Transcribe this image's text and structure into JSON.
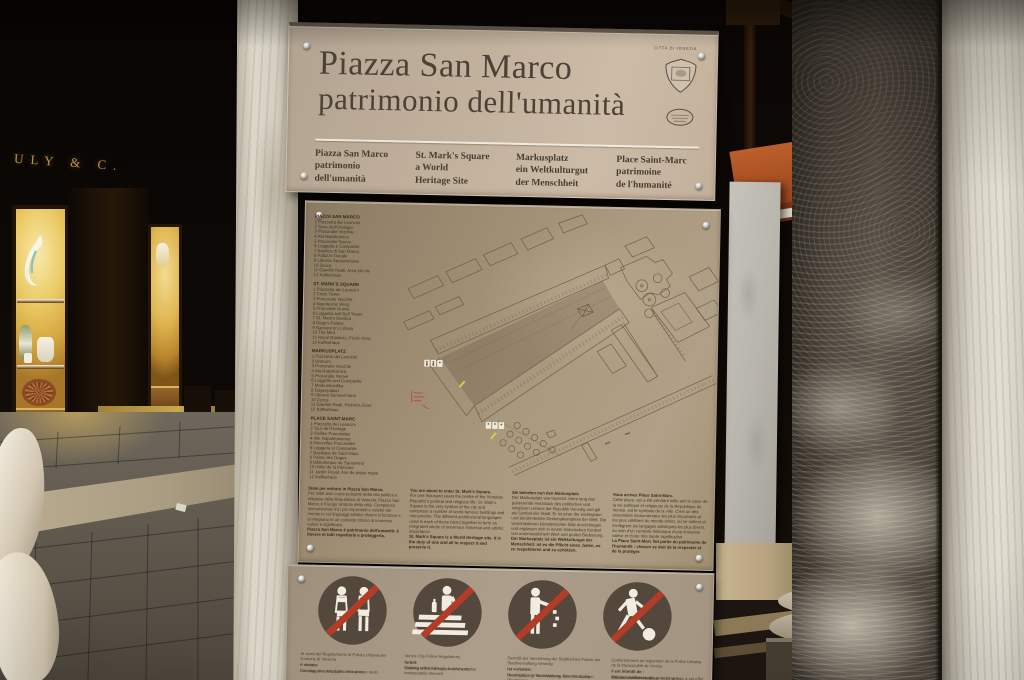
{
  "colors": {
    "panel_beige": "#c0af9b",
    "panel_tan": "#a4937a",
    "prohibition_red": "#b23c28",
    "pictogram_circle_brown": "#54473b",
    "title_brown": "#4b4136",
    "shop_glow_gold": "#eccb67"
  },
  "scene": {
    "shop_sign_text": "ULY & C."
  },
  "sign": {
    "header": {
      "title_line1": "Piazza San Marco",
      "title_line2": "patrimonio dell'umanità",
      "crest_caption": "CITTÀ DI VENEZIA",
      "translations": [
        {
          "lines": [
            "Piazza San Marco",
            "patrimonio",
            "dell'umanità"
          ]
        },
        {
          "lines": [
            "St. Mark's Square",
            "a World",
            "Heritage Site"
          ]
        },
        {
          "lines": [
            "Markusplatz",
            "ein Weltkulturgut",
            "der Menschheit"
          ]
        },
        {
          "lines": [
            "Place Saint-Marc",
            "patrimoine",
            "de l'humanité"
          ]
        }
      ]
    },
    "map_panel": {
      "legend": [
        {
          "title": "PIAZZA SAN MARCO",
          "items": [
            "1 Piazzetta dei Leoncini",
            "2 Torre dell'Orologio",
            "3 Procuratie Vecchie",
            "4 Ala Napoleonica",
            "5 Procuratie Nuove",
            "6 Loggetta e Campanile",
            "7 Basilica di San Marco",
            "8 Palazzo Ducale",
            "9 Libreria Sansoviniana",
            "10 Zecca",
            "11 Giardini Reali, Area pic-nic",
            "12 Kaffeehaus"
          ]
        },
        {
          "title": "ST. MARK'S SQUARE",
          "items": [
            "1 Piazzetta dei Leoncini",
            "2 Clock Tower",
            "3 Procuratie Vecchie",
            "4 Napoleonic Wing",
            "5 Procuratie Nuove",
            "6 Loggetta and Bell Tower",
            "7 St. Mark's Basilica",
            "8 Doge's Palace",
            "9 Sansovino's Library",
            "10 The Mint",
            "11 Royal Gardens, Picnic Area",
            "12 Kaffeehaus"
          ]
        },
        {
          "title": "MARKUSPLATZ",
          "items": [
            "1 Piazzetta dei Leoncini",
            "2 Uhrturm",
            "3 Procuratie Vecchie",
            "4 Ala Napoleonica",
            "5 Procuratie Nuove",
            "6 Loggetta und Campanile",
            "7 Markusbasilika",
            "8 Dogenpalast",
            "9 Libreria Sansoviniana",
            "10 Zecca",
            "11 Giardini Reali, Picknick-Zone",
            "12 Kaffeehaus"
          ]
        },
        {
          "title": "PLACE SAINT-MARC",
          "items": [
            "1 Piazzetta dei Leoncini",
            "2 Tour de l'Horloge",
            "3 Vieilles Procuraties",
            "4 Aile Napoléonienne",
            "5 Nouvelles Procuraties",
            "6 Loggetta et Campanile",
            "7 Basilique de Saint-Marc",
            "8 Palais des Doges",
            "9 Bibliothèque de Sansovino",
            "10 Hôtel de la Monnaie",
            "11 Jardin Royal, Aire de pique-nique",
            "12 Kaffeehaus"
          ]
        }
      ],
      "intro": [
        {
          "lead": "State per entrare in Piazza San Marco.",
          "body": "Per mille anni cuore pulsante della vita politica e religiosa della Repubblica di Venezia, Piazza San Marco è il luogo simbolo della città. Complesso monumentale tra i più importanti e celebri del mondo in cui linguaggi artistici diversi si fondono e si integrano in un contesto storico di immenso valore e significato.",
          "bold": "Piazza San Marco è patrimonio dell'umanità: è dovere di tutti rispettarla e proteggerla."
        },
        {
          "lead": "You are about to enter St. Mark's Square.",
          "body": "For one thousand years the centre of the Venetian Republic's political and religious life, St. Mark's Square is the very symbol of the city and comprises a number of world-famous buildings and monuments. The different architectural languages used in each of these blend together to form an integrated whole of enormous historical and artistic importance.",
          "bold": "St. Mark's Square is a World Heritage site. It is the duty of one and all to respect it and preserve it."
        },
        {
          "lead": "Sie betreten nun den Markusplatz.",
          "body": "Der Markusplatz war tausend Jahre lang das pulsierende Herzstück des politischen und religiösen Lebens der Republik Venedig und gilt als Symbol der Stadt. Er ist einer der wichtigsten und berühmtesten Denkmalkomplexe der Welt. Die verschiedenen künstlerischen Stile durchdringen und ergänzen sich in einem historischen Kontext von unermesslichem Wert und großer Bedeutung.",
          "bold": "Der Markusplatz ist ein Weltkulturgut der Menschheit: ist es die Pflicht eines Jeden, es zu respektieren und zu schützen."
        },
        {
          "lead": "Vous arrivez Place Saint-Marc.",
          "body": "Cette place, qui a été pendant mille ans le cœur de la vie politique et religieuse de la République de Venise, est le symbole de la ville. C'est un des ensembles monumentaux les plus importants et les plus célèbres du monde entier, où se mêlent et s'intègrent les langages artistiques les plus divers, au sein d'un contexte historique d'une immense valeur et d'une très haute signification.",
          "bold": "La Place Saint-Marc fait partie du patrimoine de l'humanité : chacun se doit de la respecter et de la protéger."
        }
      ]
    },
    "rules_panel": {
      "icons": [
        {
          "name": "no-beachwear"
        },
        {
          "name": "no-picnicking"
        },
        {
          "name": "no-littering"
        },
        {
          "name": "no-ball-games"
        }
      ],
      "columns": [
        {
          "authority": "Ai sensi del Regolamento di Polizia Urbana del Comune di Venezia",
          "forbid": "è vietato:",
          "items": [
            "Circolare in tenuta balneare o a torso nudo",
            "Danneggiare, deturpare, imbrattare"
          ]
        },
        {
          "authority": "Venice City Police Regulations",
          "forbid": "forbid:",
          "items": [
            "Walking around the city bare-chested or inadequately dressed",
            "Causing wilful damage or defacement"
          ]
        },
        {
          "authority": "Gemäß der Verordnung der Städtischen Polizei der Stadtverwaltung Venedig",
          "forbid": "ist verboten:",
          "items": [
            "Herumgehen in Badekleidung oder mit nacktem Oberkörper",
            "Beschädigung, Verunstaltung, Beschmutzung"
          ]
        },
        {
          "authority": "Conformément au règlement de la Police Urbaine de la Municipalité de Venise",
          "forbid": "il est interdit de :",
          "items": [
            "Circuler en tenue de plage ou torse nu",
            "Abîmer, souiller et salir",
            "S'asseoir en dehors des endroits prévus à cet effet et s'arrêter pour boire ou manger"
          ]
        }
      ]
    }
  }
}
